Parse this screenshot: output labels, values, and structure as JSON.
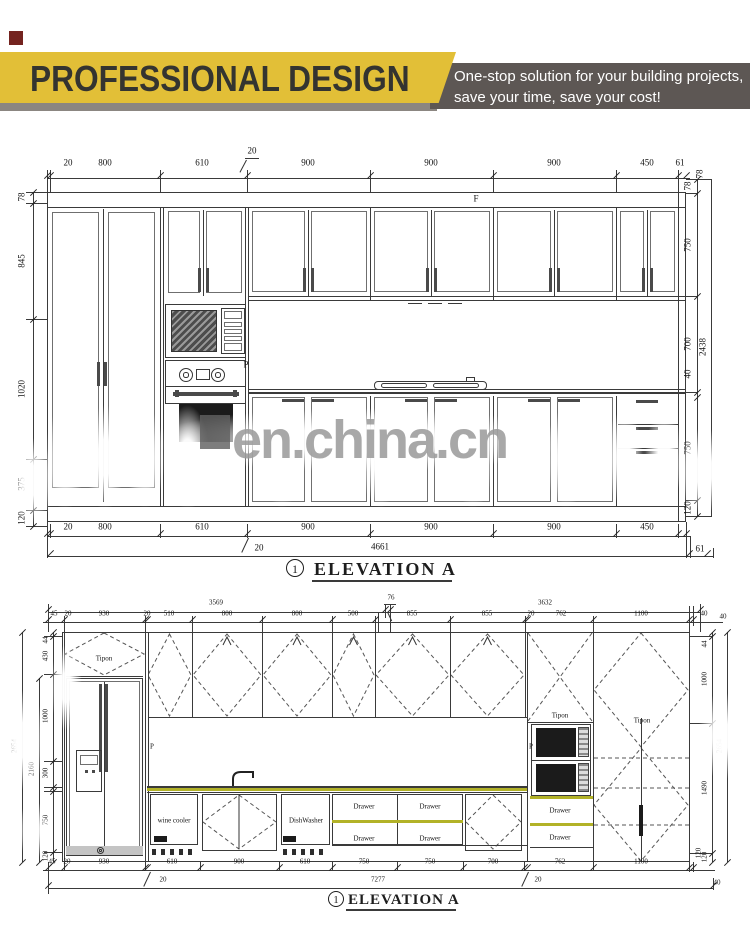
{
  "header": {
    "title": "PROFESSIONAL DESIGN",
    "tagline_line1": "One-stop solution for your building projects,",
    "tagline_line2": "save your time, save your cost!",
    "colors": {
      "yellow": "#e2bf37",
      "dark_band": "#5d5754",
      "under_strip": "#8b8681",
      "corner_square": "#74231f",
      "title_text": "#343430"
    }
  },
  "watermark": {
    "text": "en.china.cn",
    "color": "#9a9a9a",
    "square_color": "#606060"
  },
  "elevation1": {
    "drawing_no": "1",
    "title": "ELEVATION  A",
    "labels": {
      "cornice": "F",
      "panel": "P"
    },
    "dims": {
      "top": [
        "20",
        "800",
        "610",
        "900",
        "900",
        "900",
        "450",
        "61"
      ],
      "top_note": "20",
      "top_height": "78",
      "left": [
        "78",
        "845",
        "1020",
        "375",
        "120"
      ],
      "right": [
        "78",
        "750",
        "700",
        "40",
        "750",
        "120"
      ],
      "right_total": "2438",
      "bottom": [
        "20",
        "800",
        "610",
        "900",
        "900",
        "900",
        "450"
      ],
      "bottom_note": "20",
      "bottom_total": "4661",
      "bottom_end": "61"
    }
  },
  "elevation2": {
    "drawing_no": "1",
    "title": "ELEVATION A",
    "labels": {
      "tipon_fridge": "Tipon",
      "tipon_oven": "Tipon",
      "tipon_pantry": "Tipon",
      "p_left": "P",
      "p_right": "P",
      "wine_cooler": "wine cooler",
      "dishwasher": "DishWasher",
      "drawer": "Drawer"
    },
    "dims": {
      "top_totals": [
        "3569",
        "76",
        "3632"
      ],
      "top": [
        "45",
        "20",
        "930",
        "20",
        "510",
        "800",
        "800",
        "500",
        "855",
        "855",
        "20",
        "762",
        "1100",
        "40"
      ],
      "left_total": "2654",
      "left_sub": "2160",
      "left": [
        "44",
        "430",
        "1000",
        "300",
        "750",
        "120"
      ],
      "right_top": "40",
      "right": [
        "44",
        "1000",
        "1490",
        "120"
      ],
      "right_total": "2654",
      "bottom": [
        "45",
        "20",
        "930",
        "610",
        "900",
        "610",
        "750",
        "750",
        "700",
        "762",
        "1100"
      ],
      "bottom_note_left": "20",
      "bottom_total": "7277",
      "bottom_note_mid": "20",
      "bottom_end": "40",
      "bottom_right_rot": "120"
    }
  }
}
